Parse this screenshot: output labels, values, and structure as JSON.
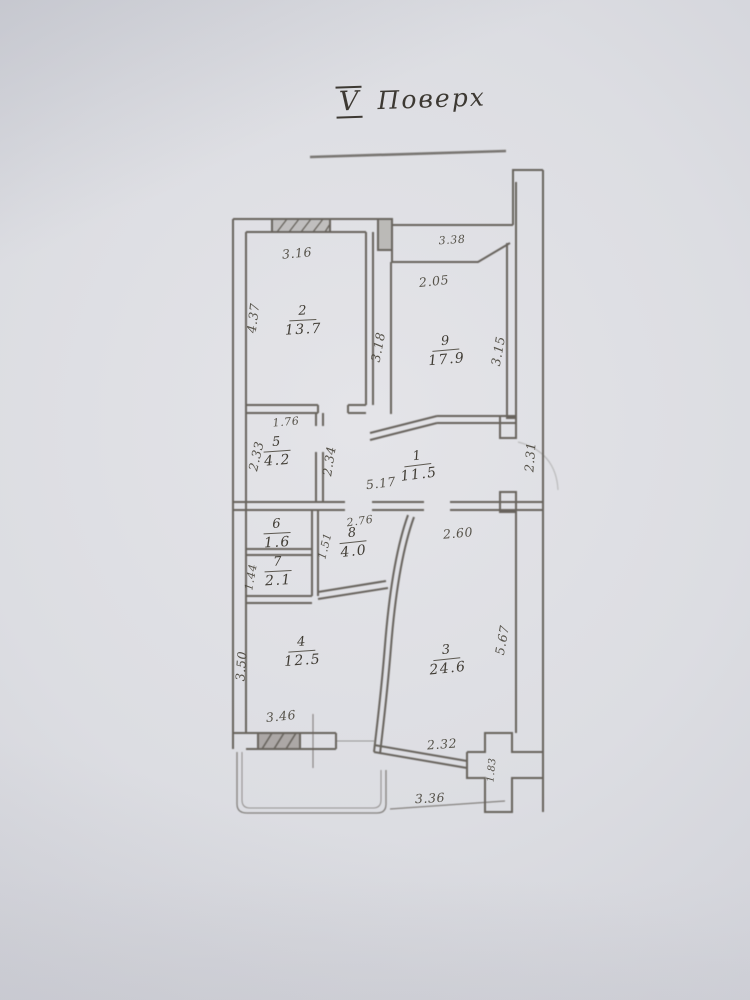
{
  "title": {
    "floor_numeral": "V",
    "floor_word": "Поверх"
  },
  "plan": {
    "rooms": [
      {
        "number": "2",
        "area": "13.7",
        "x": 303,
        "y": 321,
        "rot": -3
      },
      {
        "number": "9",
        "area": "17.9",
        "x": 446,
        "y": 351,
        "rot": -5
      },
      {
        "number": "1",
        "area": "11.5",
        "x": 418,
        "y": 466,
        "rot": -7
      },
      {
        "number": "5",
        "area": "4.2",
        "x": 277,
        "y": 452,
        "rot": -4
      },
      {
        "number": "6",
        "area": "1.6",
        "x": 277,
        "y": 534,
        "rot": -3
      },
      {
        "number": "7",
        "area": "2.1",
        "x": 278,
        "y": 572,
        "rot": -3
      },
      {
        "number": "8",
        "area": "4.0",
        "x": 353,
        "y": 543,
        "rot": -6
      },
      {
        "number": "4",
        "area": "12.5",
        "x": 302,
        "y": 652,
        "rot": -4
      },
      {
        "number": "3",
        "area": "24.6",
        "x": 447,
        "y": 660,
        "rot": -6
      }
    ],
    "dimensions": [
      {
        "text": "3.16",
        "x": 297,
        "y": 253,
        "rot": -5
      },
      {
        "text": "3.38",
        "x": 452,
        "y": 240,
        "rot": -4,
        "size": 11
      },
      {
        "text": "2.05",
        "x": 434,
        "y": 281,
        "rot": -6
      },
      {
        "text": "4.37",
        "x": 253,
        "y": 318,
        "rot": -83
      },
      {
        "text": "3.18",
        "x": 378,
        "y": 347,
        "rot": -79
      },
      {
        "text": "3.15",
        "x": 498,
        "y": 351,
        "rot": -80
      },
      {
        "text": "1.76",
        "x": 286,
        "y": 422,
        "rot": -5,
        "size": 11
      },
      {
        "text": "2.33",
        "x": 256,
        "y": 456,
        "rot": -77
      },
      {
        "text": "2.34",
        "x": 329,
        "y": 461,
        "rot": -81
      },
      {
        "text": "2.31",
        "x": 530,
        "y": 457,
        "rot": -86
      },
      {
        "text": "5.17",
        "x": 381,
        "y": 483,
        "rot": -7
      },
      {
        "text": "2.76",
        "x": 360,
        "y": 521,
        "rot": -8,
        "size": 11
      },
      {
        "text": "2.60",
        "x": 458,
        "y": 533,
        "rot": -5
      },
      {
        "text": "1.51",
        "x": 325,
        "y": 546,
        "rot": -76,
        "size": 11
      },
      {
        "text": "1.44",
        "x": 251,
        "y": 577,
        "rot": -80,
        "size": 11
      },
      {
        "text": "3.50",
        "x": 241,
        "y": 666,
        "rot": -86
      },
      {
        "text": "5.67",
        "x": 502,
        "y": 640,
        "rot": -80
      },
      {
        "text": "3.46",
        "x": 281,
        "y": 716,
        "rot": -6
      },
      {
        "text": "2.32",
        "x": 442,
        "y": 744,
        "rot": -4
      },
      {
        "text": "1.83",
        "x": 492,
        "y": 770,
        "rot": -85,
        "size": 10
      },
      {
        "text": "3.36",
        "x": 430,
        "y": 798,
        "rot": -3
      }
    ],
    "colors": {
      "paper": "#dcdde2",
      "ink": "#5b564f",
      "text": "#474339"
    }
  }
}
